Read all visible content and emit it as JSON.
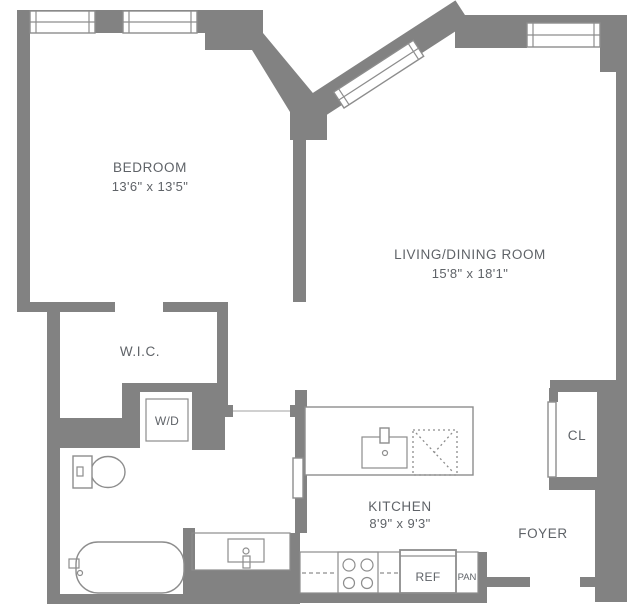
{
  "plan": {
    "title": "Apartment floor plan",
    "rooms": [
      {
        "id": "bedroom",
        "label": "BEDROOM",
        "dimensions": "13'6\" x 13'5\""
      },
      {
        "id": "living_dining",
        "label": "LIVING/DINING ROOM",
        "dimensions": "15'8\" x 18'1\""
      },
      {
        "id": "kitchen",
        "label": "KITCHEN",
        "dimensions": "8'9\" x 9'3\""
      },
      {
        "id": "walk_in_closet",
        "label": "W.I.C."
      },
      {
        "id": "foyer",
        "label": "FOYER"
      },
      {
        "id": "closet",
        "label": "CL"
      }
    ],
    "fixtures": {
      "washer_dryer": "W/D",
      "refrigerator": "REF",
      "pantry": "PAN"
    },
    "colors": {
      "wall": "#828282",
      "fixture_stroke": "#8d8d8d",
      "text": "#5f6368",
      "background": "#ffffff"
    }
  }
}
